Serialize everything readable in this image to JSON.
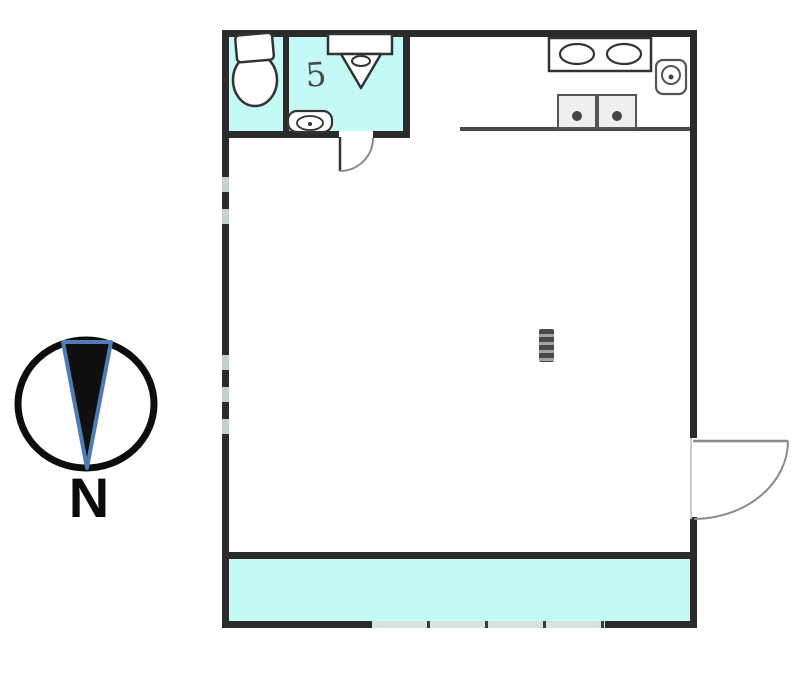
{
  "scene": {
    "type": "floor-plan",
    "background": "#ffffff"
  },
  "compass": {
    "label": "N",
    "ring_color": "#0d0d0d",
    "needle_fill": "#101010",
    "needle_outline": "#4e7db3"
  },
  "floorplan": {
    "wall_color": "#2b2b2b",
    "highlight_color": "#c4f9f6",
    "window_gray": "#c9cfc9",
    "bathroom_glyph": "5",
    "rooms": [
      {
        "label": "toilet-room",
        "highlighted": true
      },
      {
        "label": "bathroom",
        "highlighted": true
      },
      {
        "label": "main-room",
        "highlighted": false
      },
      {
        "label": "balcony",
        "highlighted": true
      }
    ],
    "fixtures": [
      "toilet",
      "bathroom-sink",
      "hand-basin",
      "double-sink-counter",
      "two-burner-stove",
      "water-heater"
    ],
    "doors": [
      "bathroom-door-swing",
      "entry-door-swing"
    ],
    "windows": [
      "left-window-upper",
      "left-window-lower",
      "bottom-sliding-window"
    ]
  }
}
